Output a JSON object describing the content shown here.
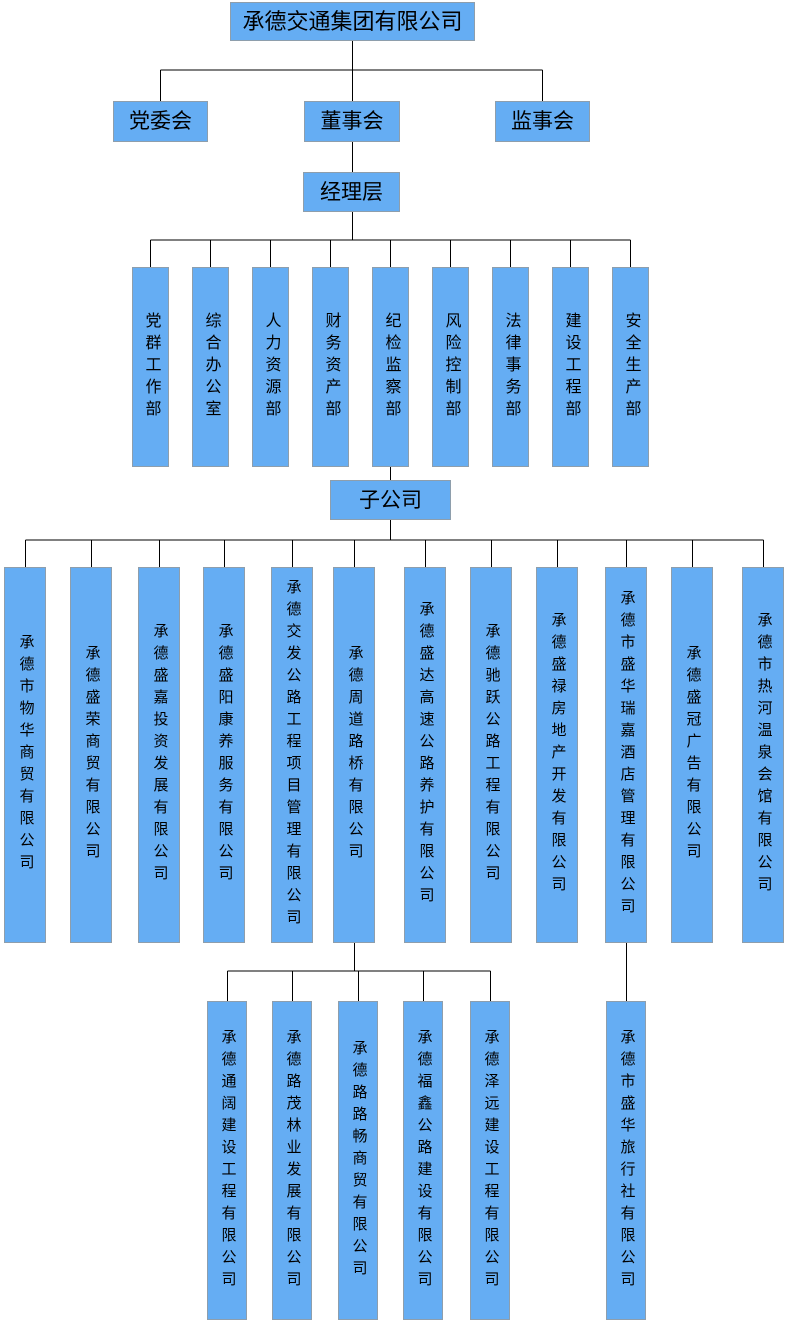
{
  "org": {
    "root": {
      "label": "承德交通集团有限公司"
    },
    "boards": [
      {
        "label": "党委会"
      },
      {
        "label": "董事会"
      },
      {
        "label": "监事会"
      }
    ],
    "management": {
      "label": "经理层"
    },
    "departments": [
      {
        "label": "党群工作部"
      },
      {
        "label": "综合办公室"
      },
      {
        "label": "人力资源部"
      },
      {
        "label": "财务资产部"
      },
      {
        "label": "纪检监察部"
      },
      {
        "label": "风险控制部"
      },
      {
        "label": "法律事务部"
      },
      {
        "label": "建设工程部"
      },
      {
        "label": "安全生产部"
      }
    ],
    "subsidiaries_header": {
      "label": "子公司"
    },
    "subsidiaries": [
      {
        "label": "承德市物华商贸有限公司"
      },
      {
        "label": "承德盛荣商贸有限公司"
      },
      {
        "label": "承德盛嘉投资发展有限公司"
      },
      {
        "label": "承德盛阳康养服务有限公司"
      },
      {
        "label": "承德交发公路工程项目管理有限公司"
      },
      {
        "label": "承德周道路桥有限公司"
      },
      {
        "label": "承德盛达高速公路养护有限公司"
      },
      {
        "label": "承德驰跃公路工程有限公司"
      },
      {
        "label": "承德盛禄房地产开发有限公司"
      },
      {
        "label": "承德市盛华瑞嘉酒店管理有限公司"
      },
      {
        "label": "承德盛冠广告有限公司"
      },
      {
        "label": "承德市热河温泉会馆有限公司"
      }
    ],
    "road_bridge_children": [
      {
        "label": "承德通阔建设工程有限公司"
      },
      {
        "label": "承德路茂林业发展有限公司"
      },
      {
        "label": "承德路路畅商贸有限公司"
      },
      {
        "label": "承德福鑫公路建设有限公司"
      },
      {
        "label": "承德泽远建设工程有限公司"
      }
    ],
    "hotel_children": [
      {
        "label": "承德市盛华旅行社有限公司"
      }
    ]
  },
  "colors": {
    "node_fill": "#65ADF3",
    "node_border": "#8E9EAC",
    "connector": "#000000",
    "text": "#000000",
    "background": "#FFFFFF"
  }
}
